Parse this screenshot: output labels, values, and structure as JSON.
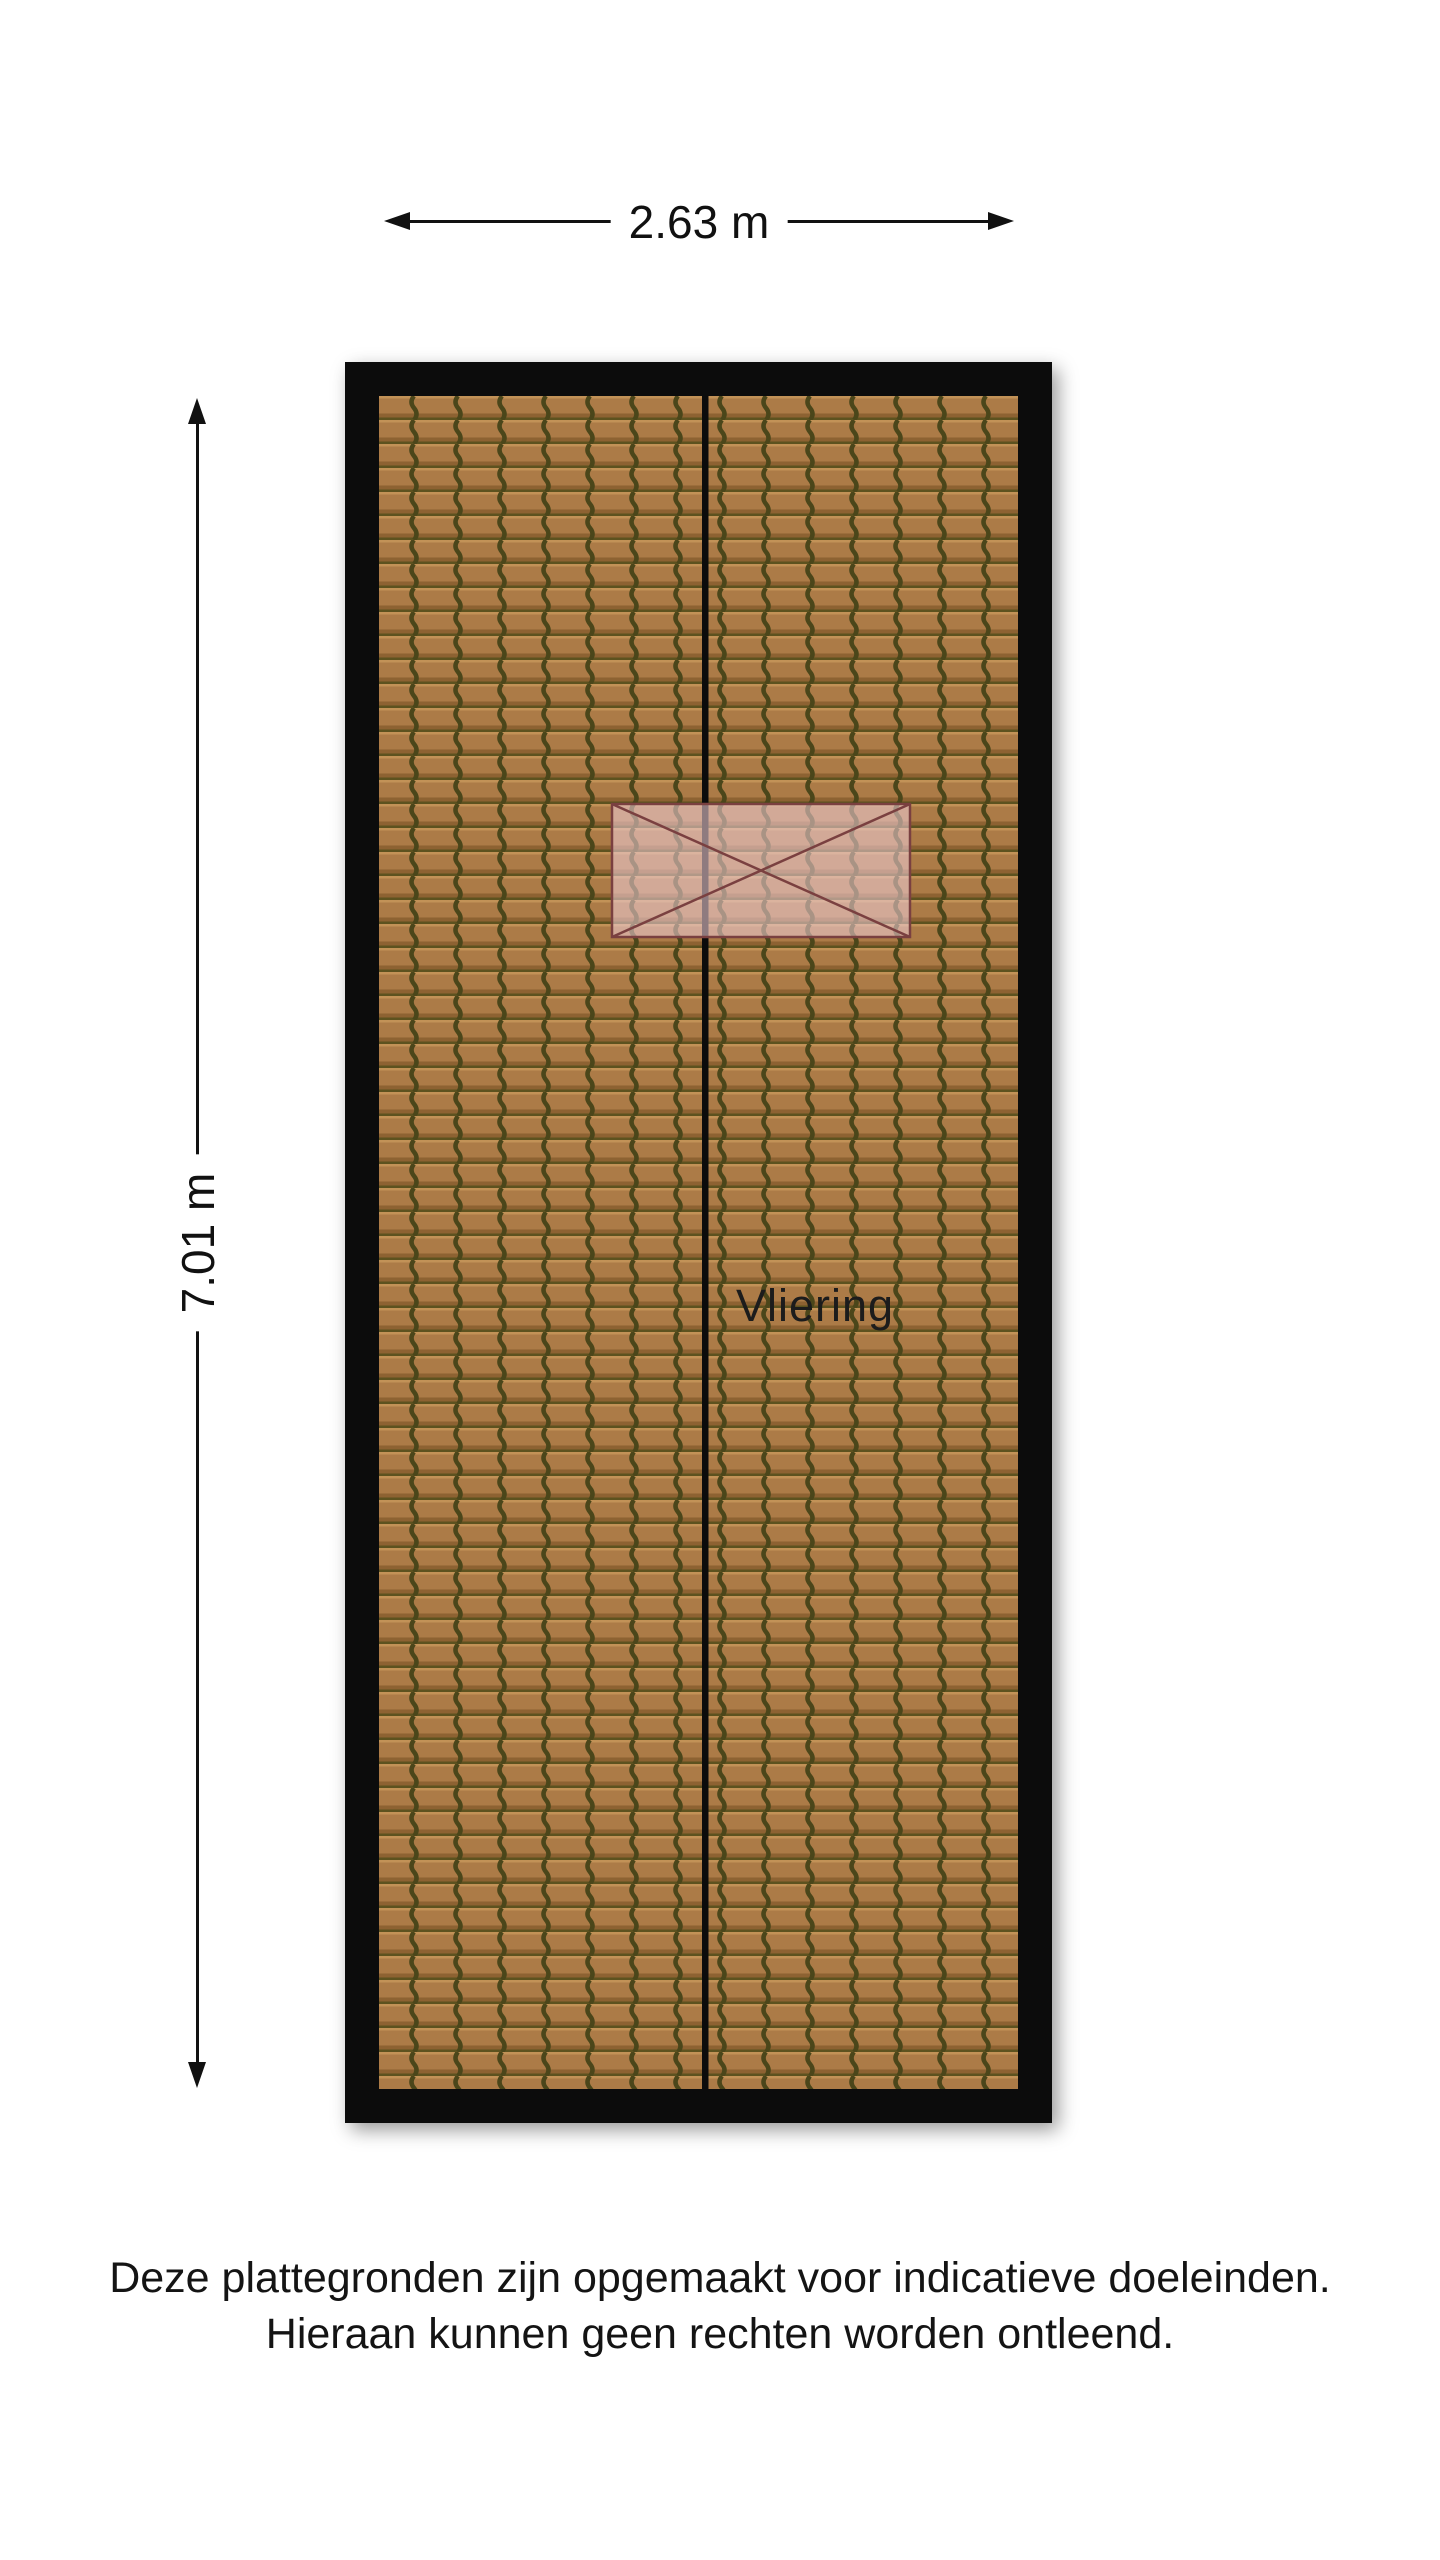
{
  "dimensions": {
    "width": {
      "label": "2.63 m"
    },
    "height": {
      "label": "7.01 m"
    }
  },
  "floorplan": {
    "room_label": "Vliering",
    "colors": {
      "wall": "#0c0c0c",
      "tile_base": "#ac7b47",
      "tile_highlight": "#c29257",
      "tile_shadow": "#8d6232",
      "tile_row_line": "#5d521f",
      "tile_groove": "#4b461a",
      "overlay_fill": "#edccd2",
      "overlay_stroke": "#7a4040"
    }
  },
  "footer": {
    "line1": "Deze plattegronden zijn opgemaakt voor indicatieve doeleinden.",
    "line2": "Hieraan kunnen geen rechten worden ontleend."
  }
}
